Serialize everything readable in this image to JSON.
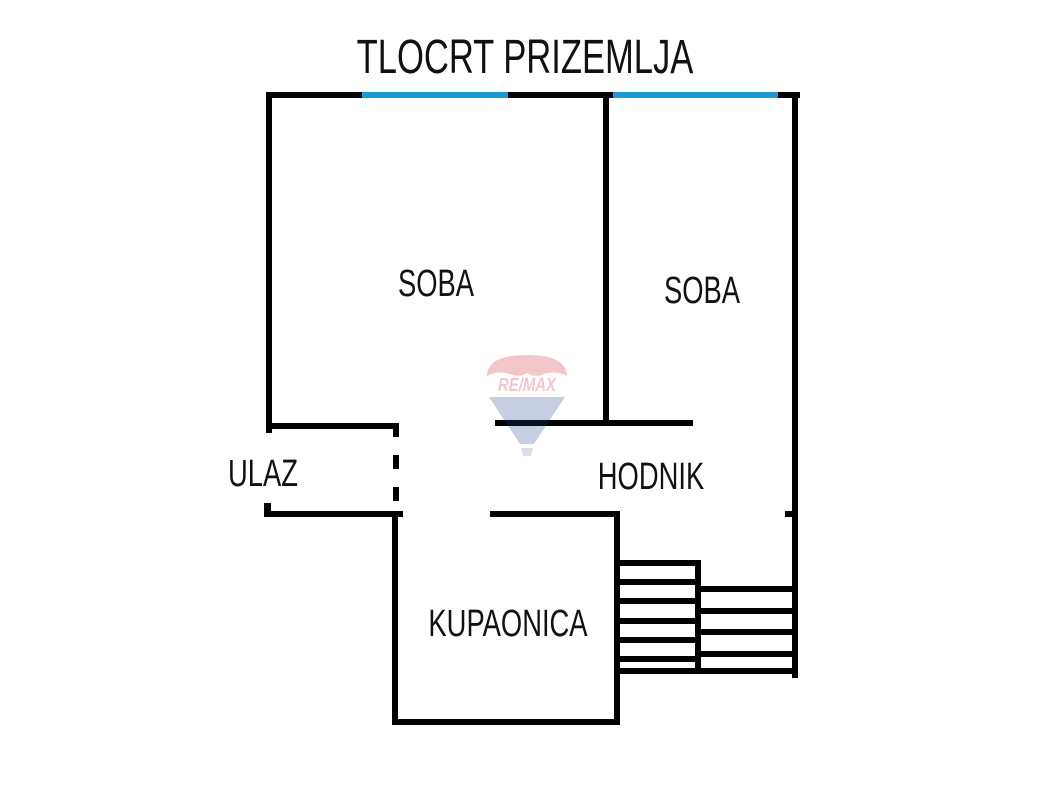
{
  "title": "TLOCRT PRIZEMLJA",
  "rooms": {
    "soba_left": "SOBA",
    "soba_right": "SOBA",
    "ulaz": "ULAZ",
    "hodnik": "HODNIK",
    "kupaonica": "KUPAONICA"
  },
  "watermark": {
    "brand": "RE/MAX"
  },
  "stairs": {
    "left_steps": 6,
    "right_steps": 4
  },
  "colors": {
    "wall": "#000000",
    "window": "#1b9ad2",
    "text": "#111111",
    "background": "#ffffff",
    "watermark_red": "#d21f2b",
    "watermark_blue": "#23418c",
    "watermark_basket": "#6f87ab"
  }
}
